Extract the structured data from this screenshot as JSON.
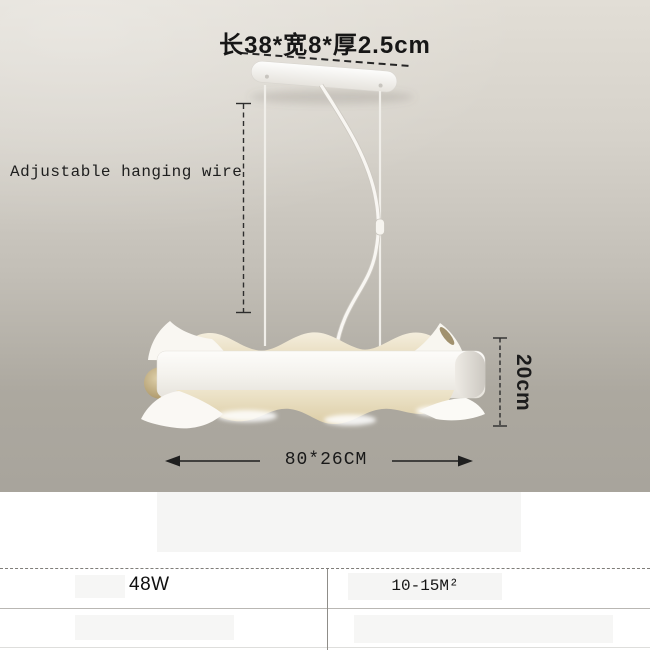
{
  "annotations": {
    "mount_dimensions": "长38*宽8*厚2.5cm",
    "hanging_wire": "Adjustable hanging wire",
    "lamp_height": "20cm",
    "lamp_width_depth": "80*26CM"
  },
  "spec_table": {
    "wattage": "48W",
    "coverage_area": "10-15M²"
  },
  "colors": {
    "wall_gradient_top": "#e2ded6",
    "wall_gradient_bottom": "#a8a49c",
    "annotation_text": "#1c1c1c",
    "lamp_shade_cream": "#e8dcc0",
    "lamp_body_white": "#f6f4ef"
  }
}
